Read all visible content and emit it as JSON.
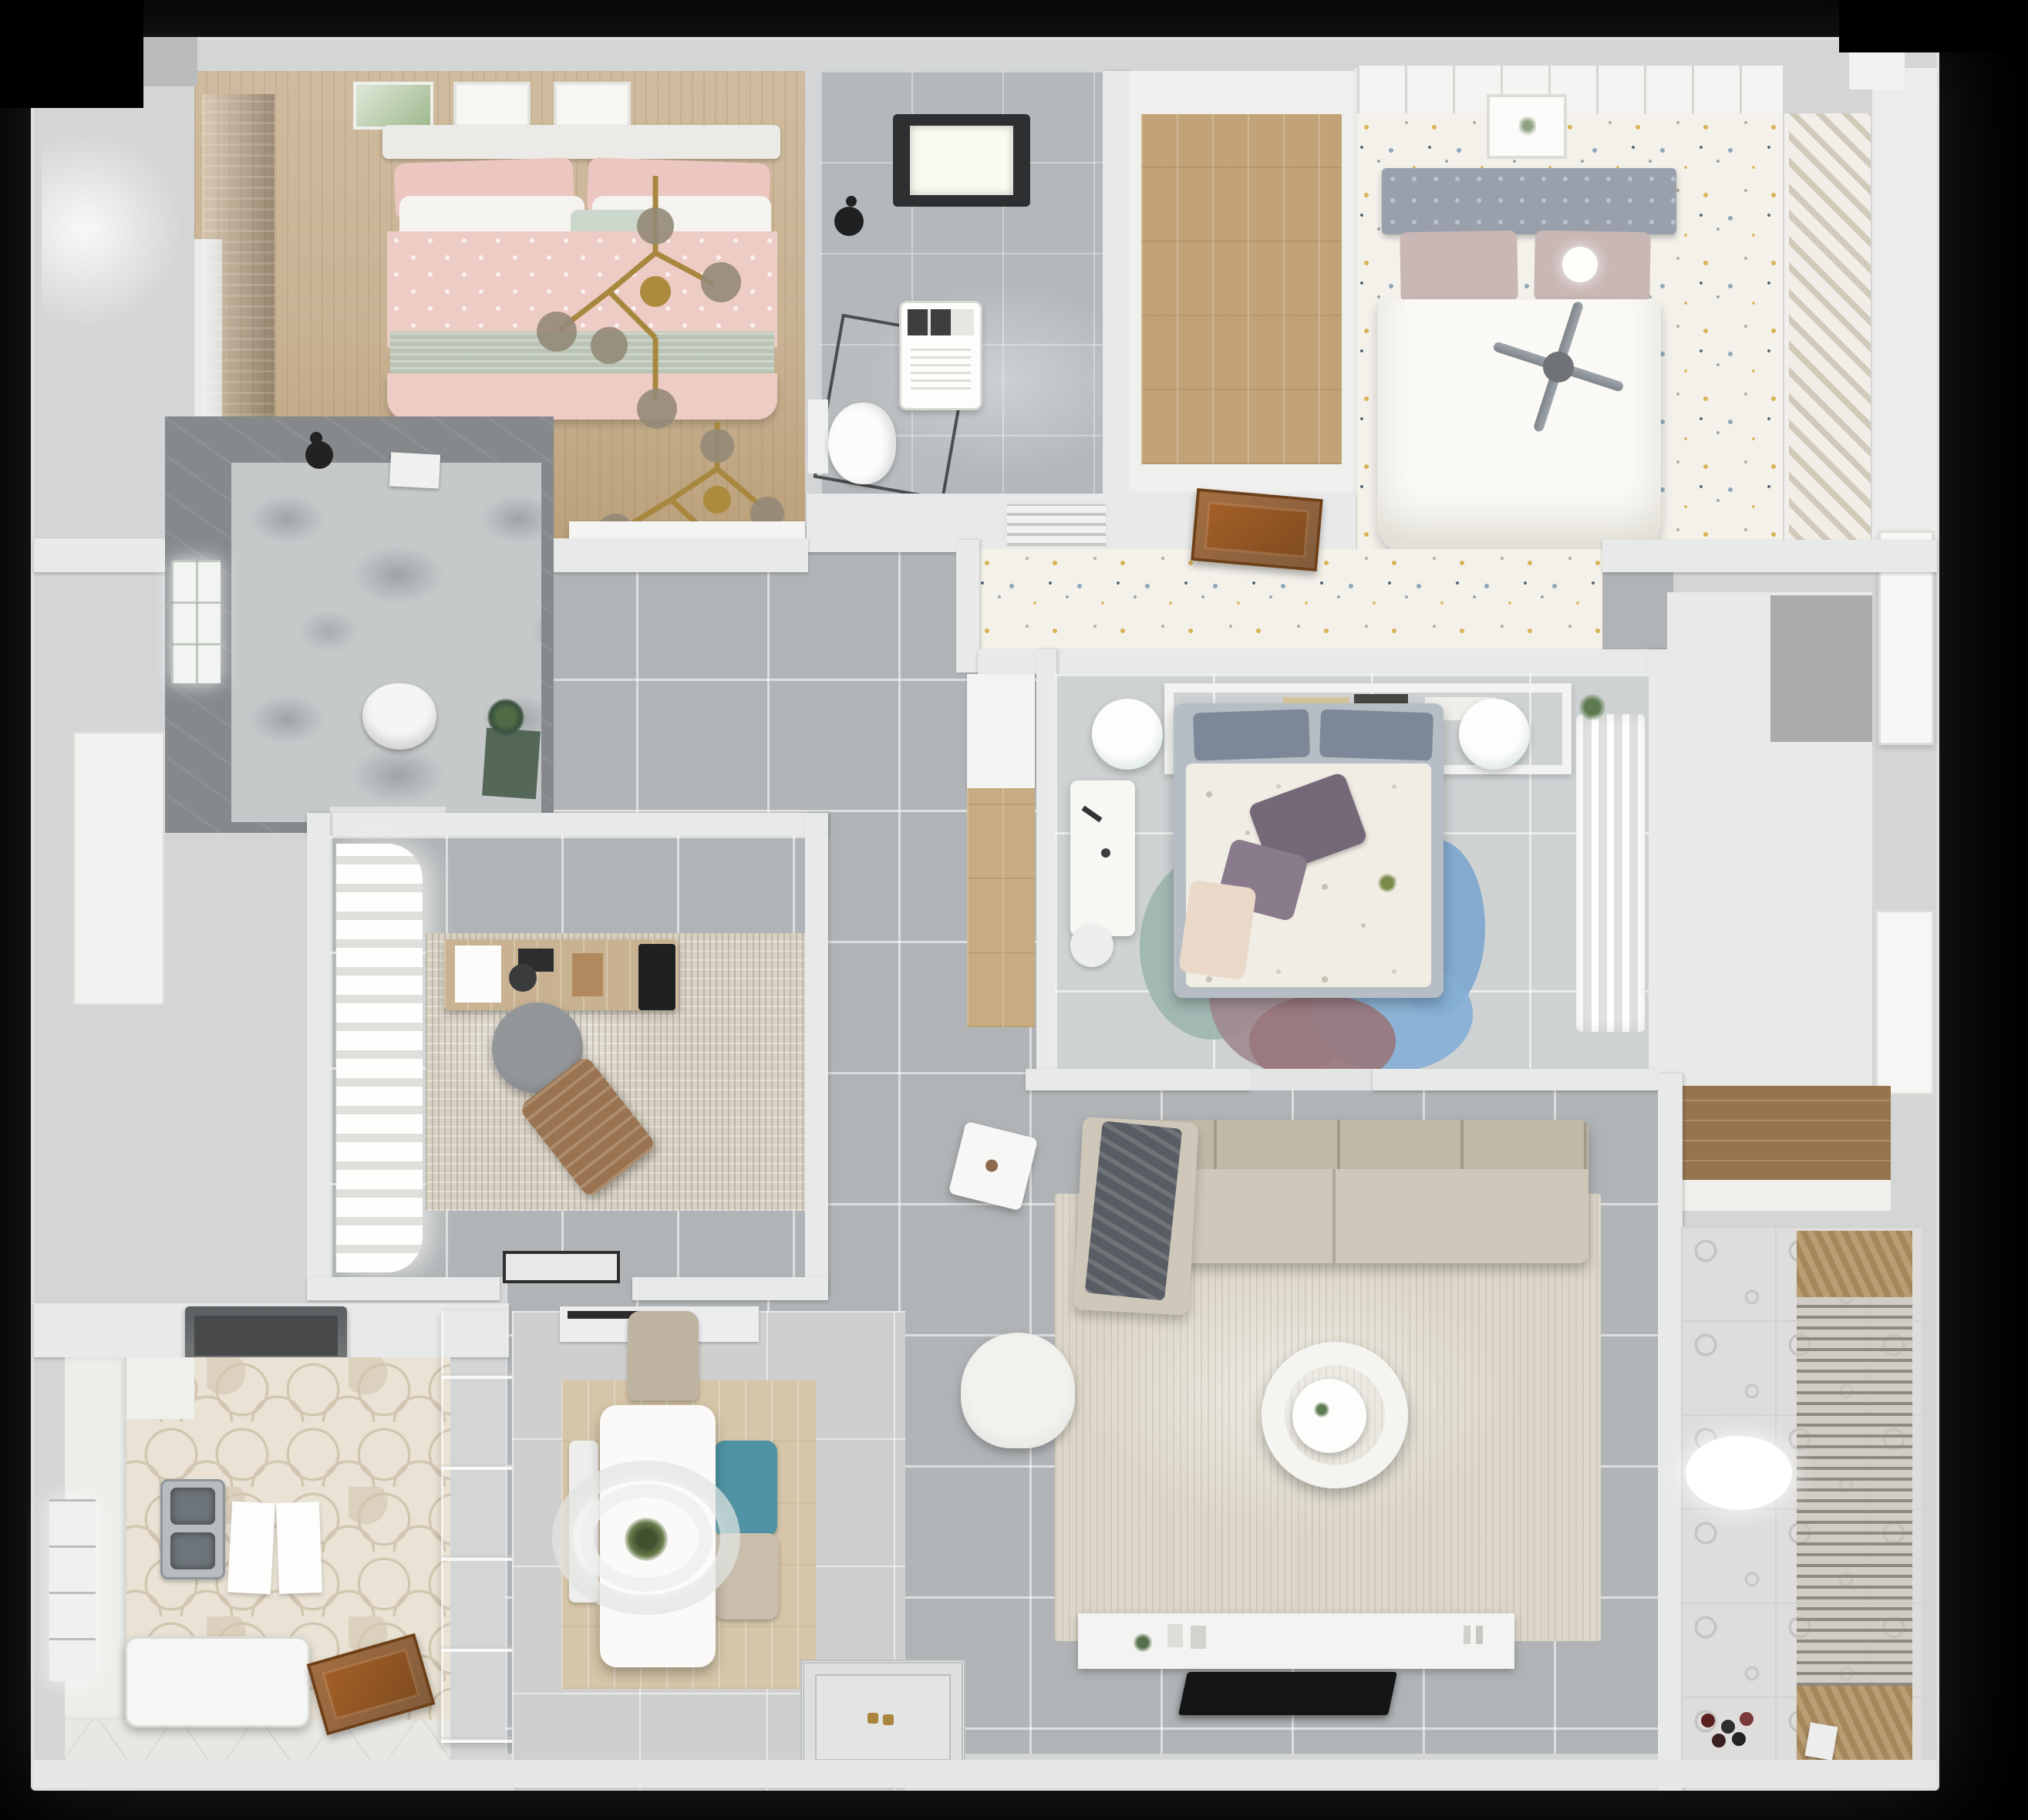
{
  "title": "Top-down 3D apartment floor plan render",
  "background_color": "#000000",
  "palette": {
    "wall": "#d3d5d6",
    "hall_tile": "#b1b4b6",
    "bedroom_tile": "#ced2d3",
    "wood_floor": "#c2a377",
    "confetti_floor": "#f3f1ea",
    "hex_tile": "#eae3d5",
    "ornament_tile": "#dedddb",
    "pink_bedding": "#eeccc6",
    "sage_blanket": "#b9c4b4",
    "white_bedding": "#fbfaf6",
    "headboard_gray": "#99a0ac",
    "teal_chair": "#4f93a4",
    "gold_chandelier": "#a8873f",
    "wood_door": "#8a5526",
    "tv_black": "#141516",
    "petal_blue": "#7ea6ce",
    "petal_mauve": "#a18a90",
    "petal_teal": "#9db5b0",
    "plant_green": "#4e6b46",
    "dark_bath_wall": "#85898c"
  },
  "rooms": {
    "bedroom_pink": {
      "label": "Bedroom with pink bed",
      "furniture": [
        "double-bed",
        "gold-chandelier",
        "wall-art-frames",
        "dark-curtain",
        "window",
        "dresser"
      ]
    },
    "bathroom_main": {
      "label": "Main bathroom",
      "furniture": [
        "skylight",
        "shower-set",
        "washing-machine",
        "toilet"
      ]
    },
    "closet_hall": {
      "label": "Closet hallway with wood floor",
      "furniture": []
    },
    "bedroom_white": {
      "label": "Bedroom with white bed",
      "furniture": [
        "double-bed",
        "tufted-headboard",
        "ceiling-fan",
        "wall-art",
        "louver-wardrobe",
        "ball-lamp"
      ]
    },
    "walkway": {
      "label": "Confetti-floor walkway",
      "furniture": [
        "ac-vent",
        "open-wood-door"
      ]
    },
    "bedroom_canopy": {
      "label": "Bedroom with canopy bed",
      "furniture": [
        "canopy-frame",
        "book-shelf",
        "double-bed",
        "petal-rug",
        "pouf",
        "pouf",
        "desk",
        "desk-chair",
        "sheer-wardrobe",
        "plant"
      ]
    },
    "closet_right": {
      "label": "Closet room",
      "furniture": [
        "door"
      ]
    },
    "storage": {
      "label": "Storage cabinet",
      "furniture": [
        "wood-cabinet"
      ]
    },
    "balcony": {
      "label": "Balcony laundry",
      "furniture": [
        "drying-rack",
        "ceiling-light",
        "toys",
        "storage-box"
      ]
    },
    "bathroom_small": {
      "label": "Shower room",
      "furniture": [
        "window",
        "shower-head",
        "towel-box",
        "toilet",
        "plant",
        "bath-mat"
      ]
    },
    "study": {
      "label": "Study",
      "furniture": [
        "billow-curtains",
        "desk",
        "office-chair",
        "lounge-chair",
        "monitor",
        "rug",
        "doormat"
      ]
    },
    "kitchen": {
      "label": "Kitchen",
      "furniture": [
        "range-hood",
        "double-sink",
        "cutting-boards",
        "island-counter",
        "wood-door",
        "window",
        "counters"
      ]
    },
    "cabinet": {
      "label": "Glass display cabinet",
      "furniture": []
    },
    "dining": {
      "label": "Dining area",
      "furniture": [
        "table",
        "pendant-lamp",
        "plant-centerpiece",
        "chair",
        "teal-chair",
        "chair",
        "bench",
        "wood-rug"
      ]
    },
    "living": {
      "label": "Living room",
      "furniture": [
        "sectional-sofa",
        "gray-blanket",
        "round-coffee-table",
        "armchair",
        "side-table",
        "tv-console",
        "tv",
        "rug"
      ]
    },
    "entry": {
      "label": "Entry with decorative door mat",
      "furniture": [
        "door-mat",
        "gold-handle"
      ]
    }
  }
}
